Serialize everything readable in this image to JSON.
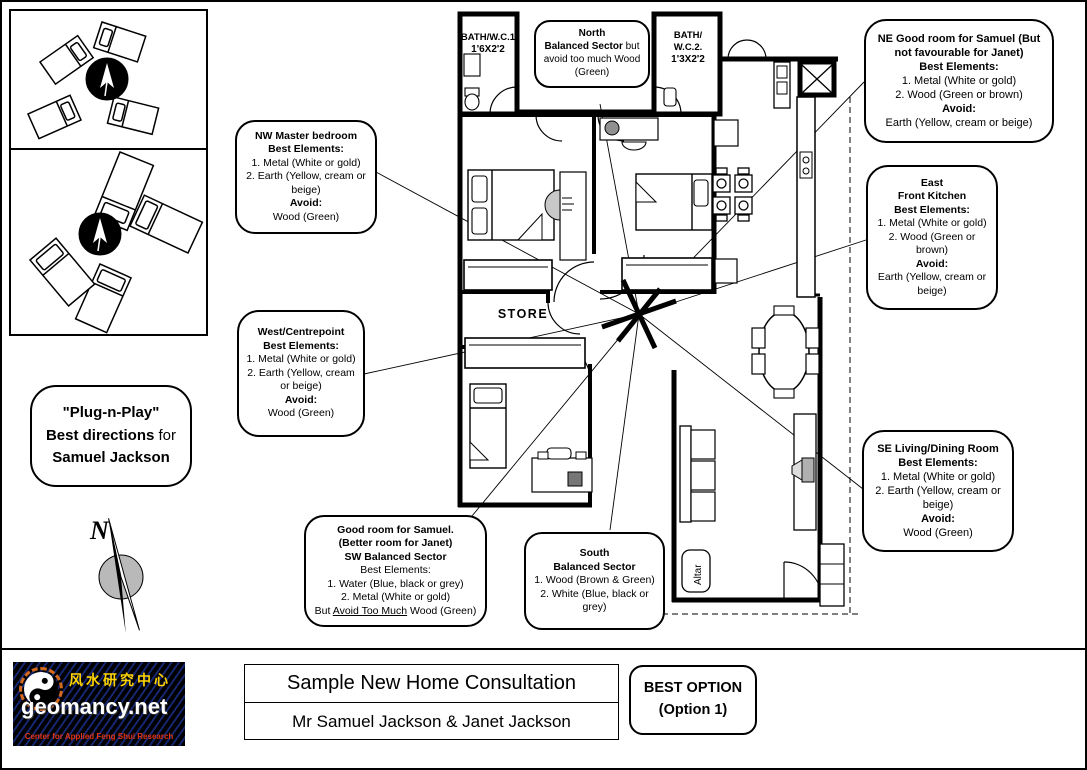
{
  "colors": {
    "wall": "#000000",
    "compass_gray": "#b9b9b9",
    "logo_bg": "#000000",
    "logo_stripe": "#1b2f8a",
    "logo_chinese": "#ffd400",
    "logo_domain": "#ffffff",
    "logo_tagline": "#e03414",
    "bagua_orange": "#d2691e"
  },
  "icons": {
    "bed_cluster_top": "four-beds-around-compass-icon",
    "bed_cluster_bottom": "four-beds-around-compass-icon",
    "compass": "compass-arrow-icon",
    "north_needle": "north-needle-icon",
    "yin_yang": "yin-yang-icon",
    "centre_star": "centrepoint-star-icon"
  },
  "floor_plan": {
    "labels": {
      "bath1": [
        "BATH/W.C.1",
        "1'6X2'2"
      ],
      "bath2": [
        "BATH/",
        "W.C.2.",
        "1'3X2'2"
      ],
      "store": "STORE",
      "altar": "Altar",
      "compass_n": "N"
    }
  },
  "callouts": {
    "north": {
      "t1": "North",
      "t2b": "Balanced Sector",
      "t2r": " but",
      "b1": "avoid too much Wood",
      "b2": "(Green)"
    },
    "ne": {
      "t1": "NE Good room for Samuel (But",
      "t2": "not favourable for Janet)",
      "t3": "Best Elements:",
      "b1": "1. Metal (White or gold)",
      "b2": "2. Wood (Green or brown)",
      "t4": "Avoid:",
      "b3": "Earth (Yellow, cream or beige)"
    },
    "nw": {
      "t1": "NW Master bedroom",
      "t2": "Best Elements:",
      "b1": "1. Metal (White or gold)",
      "b2": "2. Earth (Yellow, cream or beige)",
      "t3": "Avoid:",
      "b3": "Wood (Green)"
    },
    "east": {
      "t1": "East",
      "t2": "Front Kitchen",
      "t3": "Best Elements:",
      "b1": "1. Metal (White or gold)",
      "b2": "2. Wood (Green or brown)",
      "t4": "Avoid:",
      "b3": "Earth (Yellow, cream or beige)"
    },
    "west": {
      "t1": "West/Centrepoint",
      "t2": "Best Elements:",
      "b1": "1. Metal (White or gold)",
      "b2": "2. Earth (Yellow, cream or beige)",
      "t3": "Avoid:",
      "b3": "Wood (Green)"
    },
    "se": {
      "t1": "SE Living/Dining Room",
      "t2": "Best Elements:",
      "b1": "1. Metal (White or gold)",
      "b2": "2. Earth (Yellow, cream or beige)",
      "t3": "Avoid:",
      "b3": "Wood (Green)"
    },
    "sw": {
      "t1": "Good room for Samuel.",
      "t2": "(Better room for Janet)",
      "t3": "SW Balanced Sector",
      "b0": "Best Elements:",
      "b1": "1. Water (Blue, black or grey)",
      "b2": "2. Metal (White or gold)",
      "b3pre": "But ",
      "b3u": "Avoid Too Much",
      "b3post": " Wood (Green)"
    },
    "south": {
      "t1": "South",
      "t2": "Balanced Sector",
      "b1": "1. Wood (Brown & Green)",
      "b2": "2. White (Blue, black or grey)"
    }
  },
  "plug_n_play": {
    "l1": "\"Plug-n-Play\"",
    "l2b": "Best directions",
    "l2r": " for",
    "l3": "Samuel Jackson"
  },
  "footer": {
    "logo": {
      "chinese": "风水研究中心",
      "domain": "geomancy.net",
      "tagline": "Center for Applied Feng Shui Research"
    },
    "project_title": "Sample New Home Consultation",
    "client_line": "Mr Samuel Jackson & Janet Jackson",
    "best_option": {
      "line1": "BEST OPTION",
      "line2": "(Option 1)"
    }
  }
}
